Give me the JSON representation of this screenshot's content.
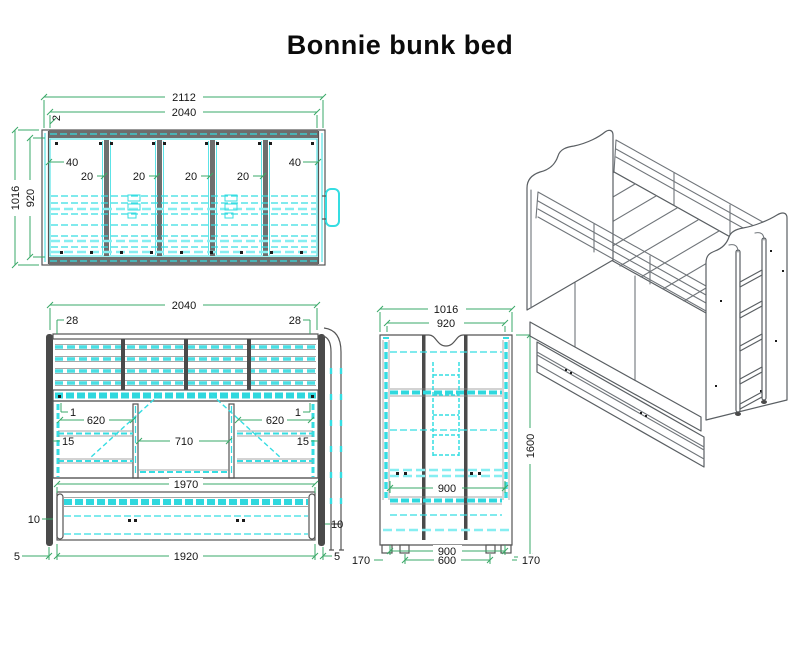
{
  "title": "Bonnie bunk bed",
  "colors": {
    "detail_cyan": "#35dde2",
    "dimension_green": "#3aa968",
    "structure_gray": "#4a4a4a",
    "text": "#161616"
  },
  "top_view": {
    "overall_length": "2112",
    "inner_length": "2040",
    "edge_thickness": "2",
    "overall_depth": "1016",
    "inner_depth": "920",
    "gap_left": "40",
    "gap_right": "40",
    "gap_1": "20",
    "gap_2": "20",
    "gap_3": "20",
    "gap_4": "20"
  },
  "front_view": {
    "length": "2040",
    "inset_left": "28",
    "inset_right": "28",
    "gap_left": "1",
    "gap_right": "1",
    "shelf_left": "620",
    "shelf_right": "620",
    "lip_left": "15",
    "lip_right": "15",
    "desk_opening": "710",
    "trundle_length": "1970",
    "clearance_left": "10",
    "clearance_right": "10",
    "offset_left": "5",
    "offset_right": "5",
    "base_length": "1920"
  },
  "side_view": {
    "overall_depth": "1016",
    "inner_depth": "920",
    "overall_height": "1600",
    "inner_width": "900",
    "foot_left": "170",
    "foot_right": "170",
    "base_width": "900",
    "base_inner": "600"
  }
}
